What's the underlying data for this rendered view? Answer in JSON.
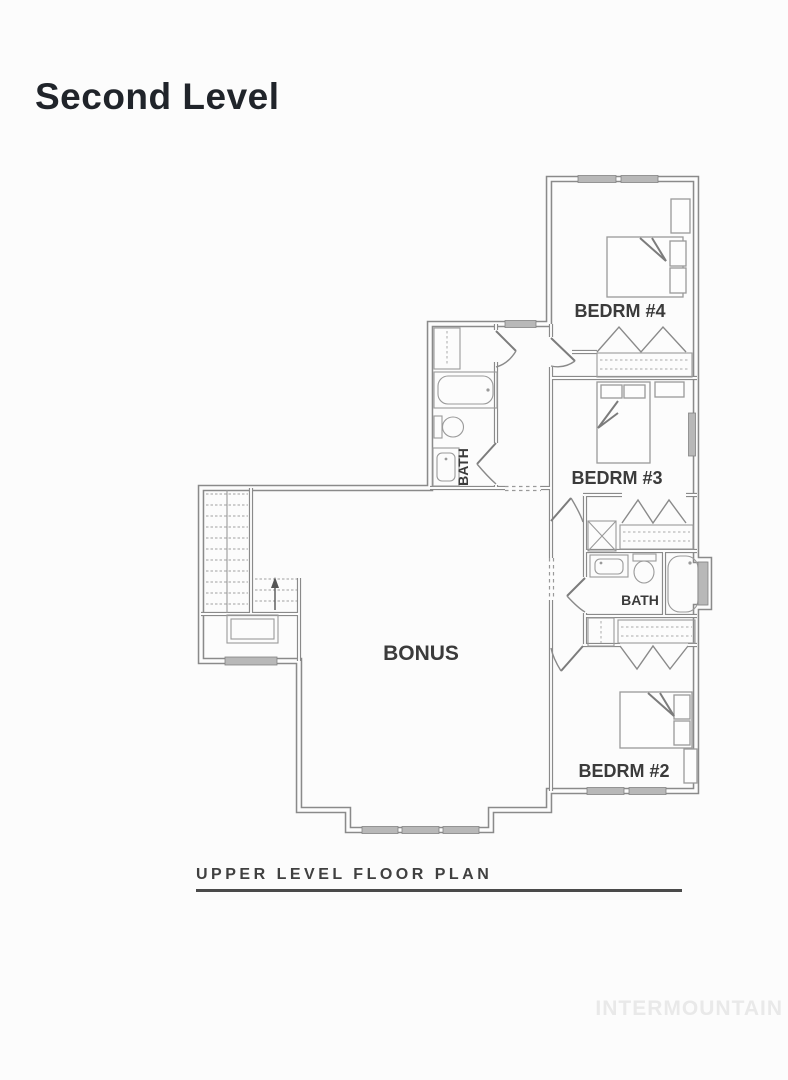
{
  "page": {
    "title": "Second Level",
    "caption": "UPPER LEVEL FLOOR PLAN",
    "watermark": "INTERMOUNTAIN"
  },
  "plan": {
    "name": "Upper level floor plan",
    "labels": {
      "bedrm4": "BEDRM #4",
      "bedrm3": "BEDRM #3",
      "bedrm2": "BEDRM #2",
      "bath_upper": "BATH",
      "bath_middle": "BATH",
      "bonus": "BONUS"
    },
    "features": [
      "stairs with up arrow",
      "two bathrooms",
      "three bedrooms with closets",
      "bonus room with bay window"
    ]
  },
  "colors": {
    "background": "#fcfcfc",
    "wall_line": "#8a8a8a",
    "fixture_line": "#9a9a9a",
    "window_fill": "#b8b8b8",
    "label_text": "#3b3b3b",
    "title_text": "#20242a",
    "caption_text": "#404040",
    "underline": "#4a4a4a",
    "watermark_text": "#e9e9e9"
  }
}
